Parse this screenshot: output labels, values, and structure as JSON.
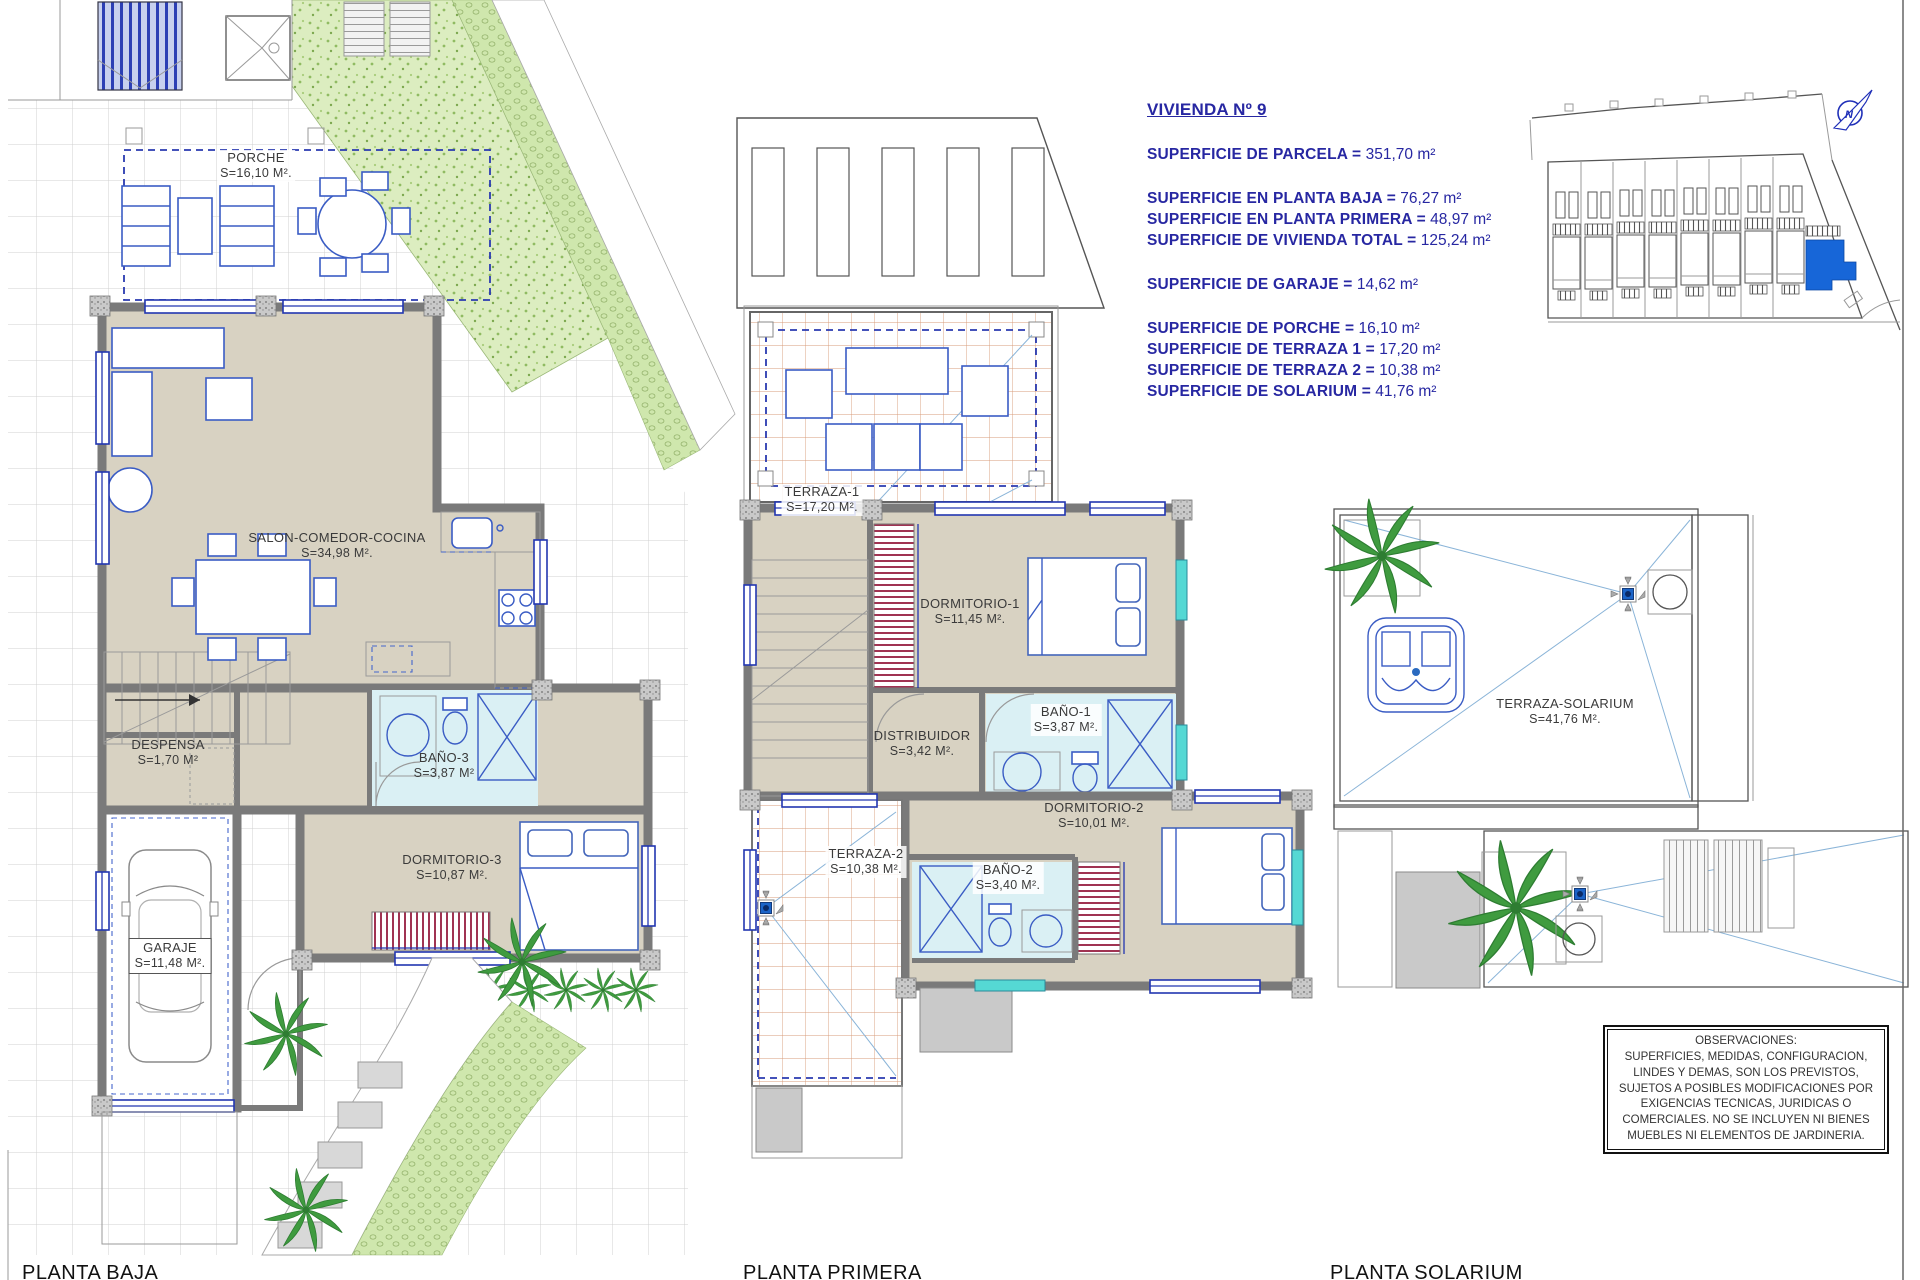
{
  "title_block": {
    "title": "VIVIENDA Nº 9",
    "lines": [
      {
        "label": "SUPERFICIE DE PARCELA =",
        "value": "351,70 m²"
      },
      {
        "label": "SUPERFICIE EN PLANTA BAJA =",
        "value": "76,27 m²"
      },
      {
        "label": "SUPERFICIE EN PLANTA PRIMERA =",
        "value": "48,97 m²"
      },
      {
        "label": "SUPERFICIE DE VIVIENDA TOTAL =",
        "value": "125,24 m²"
      },
      {
        "label": "SUPERFICIE DE GARAJE =",
        "value": "14,62 m²"
      },
      {
        "label": "SUPERFICIE DE PORCHE =",
        "value": "16,10 m²"
      },
      {
        "label": "SUPERFICIE DE TERRAZA 1 =",
        "value": "17,20 m²"
      },
      {
        "label": "SUPERFICIE DE TERRAZA 2 =",
        "value": "10,38 m²"
      },
      {
        "label": "SUPERFICIE DE SOLARIUM =",
        "value": "41,76 m²"
      }
    ]
  },
  "plans": {
    "baja": {
      "caption": "PLANTA BAJA",
      "rooms": {
        "porche": {
          "name": "PORCHE",
          "area": "S=16,10 M²."
        },
        "salon": {
          "name": "SALON-COMEDOR-COCINA",
          "area": "S=34,98 M²."
        },
        "despensa": {
          "name": "DESPENSA",
          "area": "S=1,70 M²"
        },
        "bano3": {
          "name": "BAÑO-3",
          "area": "S=3,87 M²"
        },
        "dormitorio3": {
          "name": "DORMITORIO-3",
          "area": "S=10,87 M²."
        },
        "garaje": {
          "name": "GARAJE",
          "area": "S=11,48 M²."
        }
      }
    },
    "primera": {
      "caption": "PLANTA PRIMERA",
      "rooms": {
        "terraza1": {
          "name": "TERRAZA-1",
          "area": "S=17,20 M²."
        },
        "dormitorio1": {
          "name": "DORMITORIO-1",
          "area": "S=11,45 M²."
        },
        "distribuidor": {
          "name": "DISTRIBUIDOR",
          "area": "S=3,42 M²."
        },
        "bano1": {
          "name": "BAÑO-1",
          "area": "S=3,87 M²."
        },
        "dormitorio2": {
          "name": "DORMITORIO-2",
          "area": "S=10,01 M²."
        },
        "bano2": {
          "name": "BAÑO-2",
          "area": "S=3,40 M²."
        },
        "terraza2": {
          "name": "TERRAZA-2",
          "area": "S=10,38 M²."
        }
      }
    },
    "solarium": {
      "caption": "PLANTA SOLARIUM",
      "rooms": {
        "terrazaSolarium": {
          "name": "TERRAZA-SOLARIUM",
          "area": "S=41,76 M²."
        }
      }
    }
  },
  "site_plan": {
    "north_label": "N"
  },
  "observations": {
    "text": "OBSERVACIONES:\nSUPERFICIES, MEDIDAS, CONFIGURACION,\nLINDES Y DEMAS, SON LOS PREVISTOS,\nSUJETOS A POSIBLES MODIFICACIONES POR\nEXIGENCIAS TECNICAS, JURIDICAS O\nCOMERCIALES. NO SE INCLUYEN NI BIENES\nMUEBLES NI ELEMENTOS DE JARDINERIA."
  },
  "colors": {
    "info_text": "#2727a2",
    "highlight_unit": "#1766d8",
    "wall": "#7a7a7a",
    "interior_floor": "#d8d2c2",
    "bathroom_floor": "#daf0f4",
    "tile_line": "#d79b79",
    "lawn": "#dcedc0",
    "closet_hatch": "#a03352",
    "glass": "#55d8d4"
  }
}
